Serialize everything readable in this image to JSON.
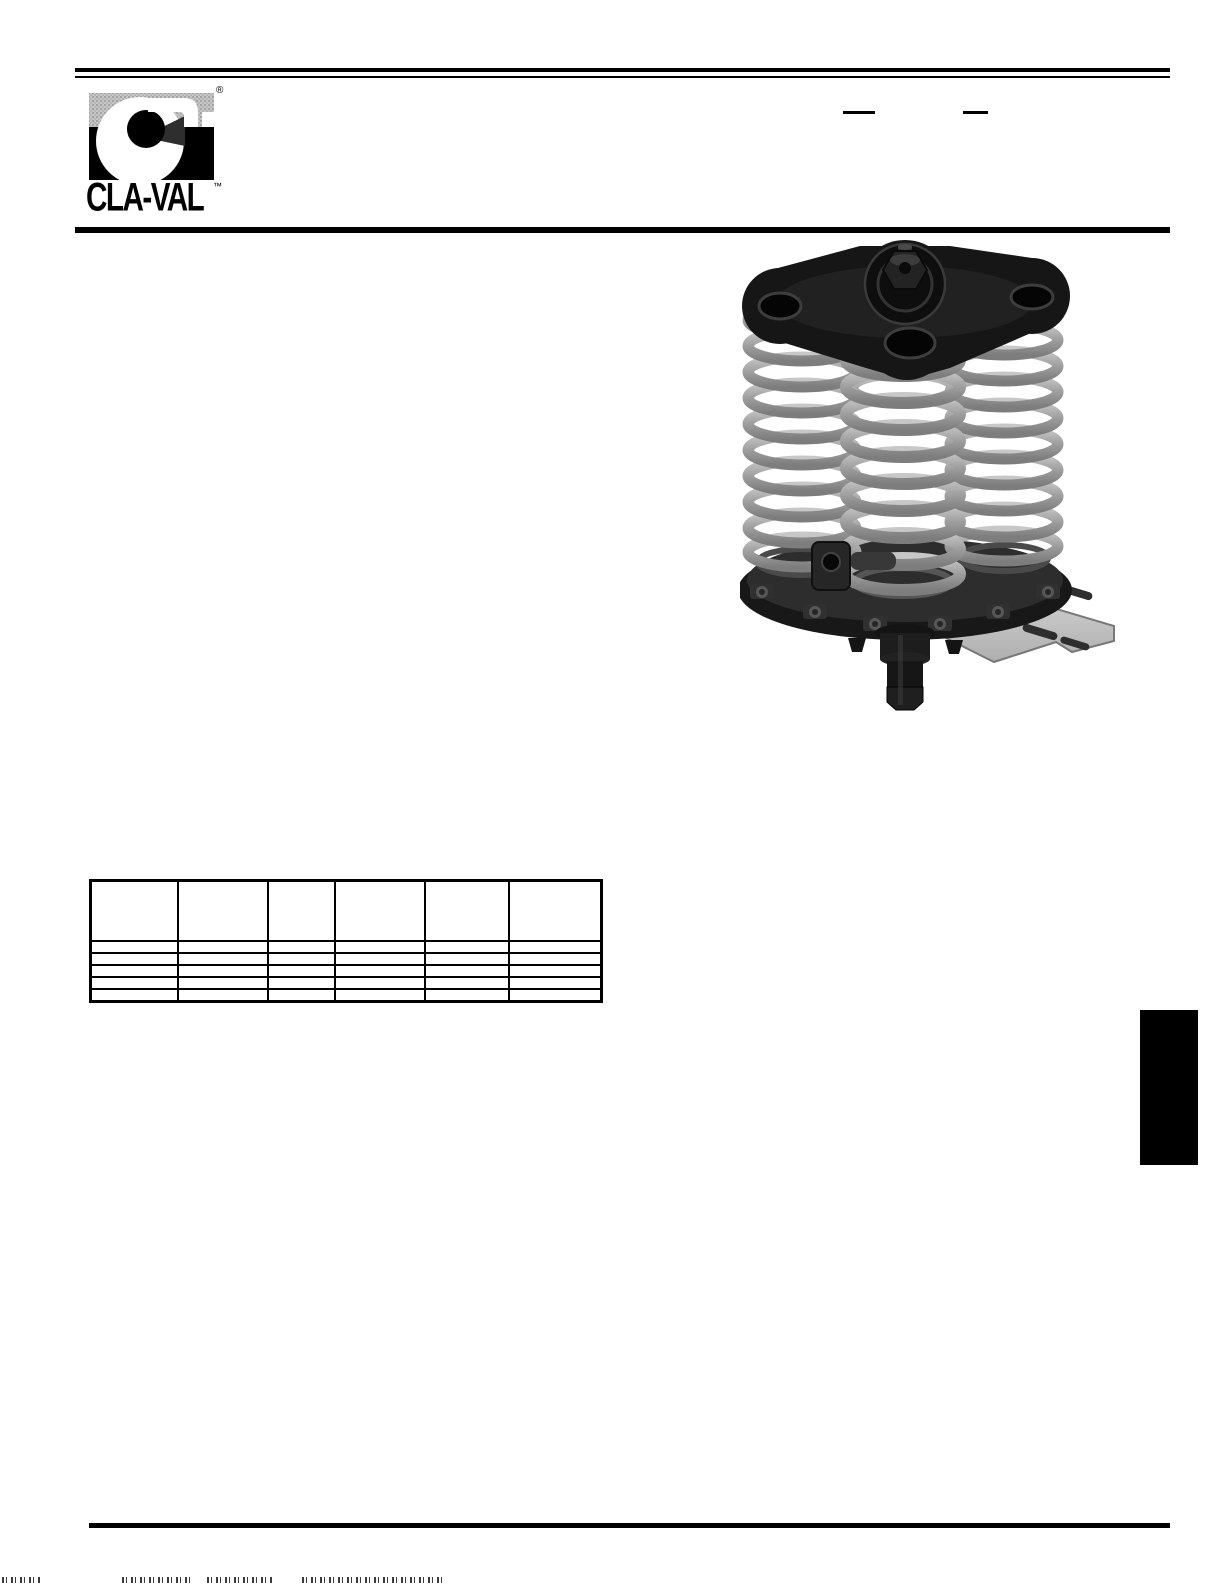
{
  "page": {
    "background": "#ffffff",
    "rule_color": "#000000"
  },
  "branding": {
    "wordmark": "CLA-VAL",
    "registered_symbol": "®",
    "trademark_symbol": "™",
    "logo_halftone_gray": "#b9b9b9",
    "logo_black": "#000000"
  },
  "header": {
    "model_blank_line_count": 2
  },
  "product_image": {
    "alt": "3D rendering of a multi-spring valve assembly: clover-shaped black top plate with center hex nut, bank of gray coil springs, bolted circular base plate with side boss, lower stem with hex tip, and a flat slotted mounting bracket extending right",
    "spring_color": "#a2a2a2",
    "plate_color": "#181818",
    "bracket_color": "#c8c8c8"
  },
  "spec_table": {
    "columns": [
      "",
      "",
      "",
      "",
      "",
      ""
    ],
    "rows": [
      [
        "",
        "",
        "",
        "",
        "",
        ""
      ],
      [
        "",
        "",
        "",
        "",
        "",
        ""
      ],
      [
        "",
        "",
        "",
        "",
        "",
        ""
      ],
      [
        "",
        "",
        "",
        "",
        "",
        ""
      ],
      [
        "",
        "",
        "",
        "",
        "",
        ""
      ]
    ]
  },
  "side_tab": {
    "label": ""
  }
}
